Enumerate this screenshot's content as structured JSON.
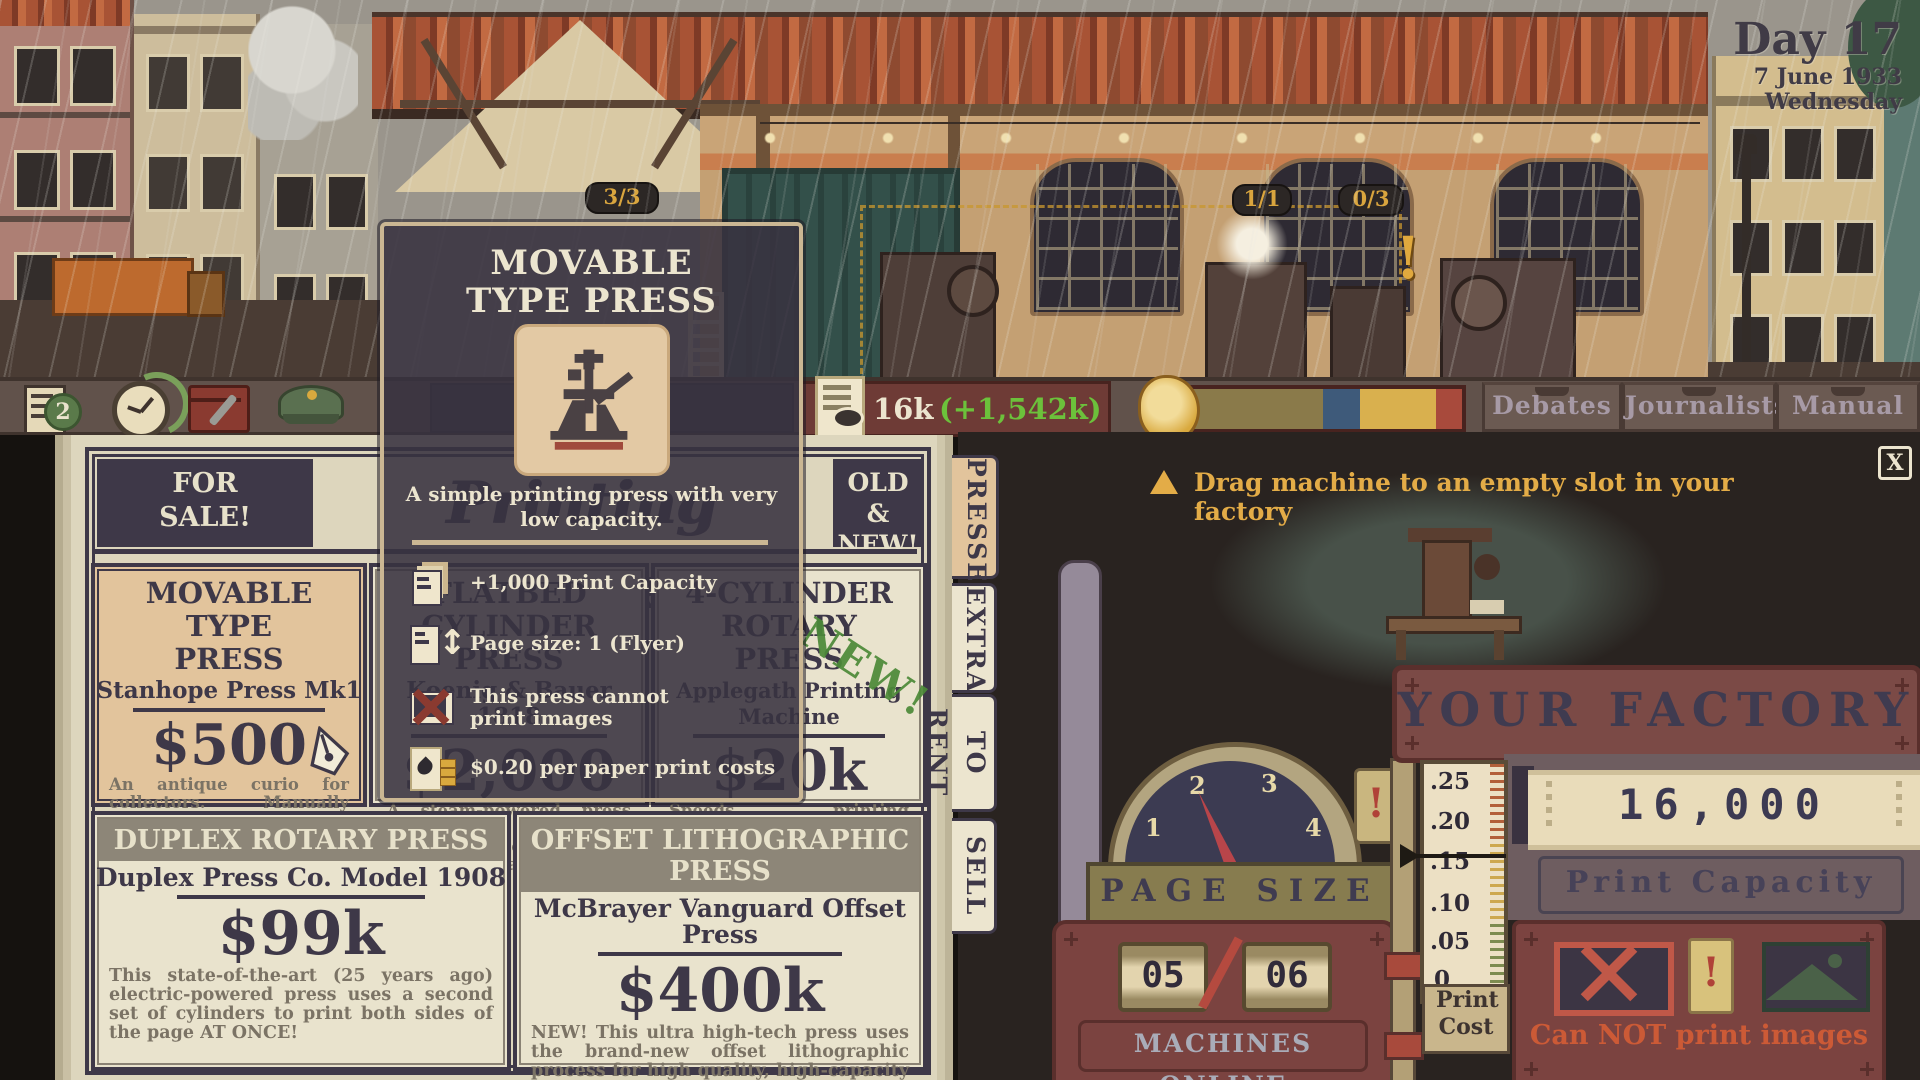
{
  "colors": {
    "money_green": "#6cc13b",
    "warning_gold": "#e3ac47",
    "alert_red": "#cc5a36",
    "paper_cream": "#e9e3cd",
    "ink_dark": "#3e3848",
    "maroon_panel": "#7b4340",
    "selected_tan": "#e2c49c"
  },
  "scene": {
    "date_day": "Day 17",
    "date_line": "7 June 1933",
    "date_weekday": "Wednesday",
    "slot_counters": [
      "3/3",
      "1/1",
      "0/3"
    ],
    "machine_alert": "!"
  },
  "hud": {
    "tasks_count": "2",
    "dim_resource": "20k",
    "money": "16k",
    "money_delta": "(+1,542k)",
    "icons": [
      "tasks-checklist-icon",
      "timer-clock-icon",
      "toolbox-icon",
      "police-cap-icon",
      "hammer-icon",
      "newspaper-stack-icon",
      "gold-paper-icon"
    ],
    "menu": [
      {
        "label": "Debates"
      },
      {
        "label": "Journalists"
      },
      {
        "label": "Manual"
      }
    ]
  },
  "catalog": {
    "sale_tag": "FOR SALE!",
    "title": "Printing Presses",
    "new_tag": "OLD & NEW!",
    "items": [
      {
        "name": "MOVABLE TYPE PRESS",
        "maker": "Stanhope Press Mk1",
        "price": "$500",
        "desc": "An antique curio for collectors. Manually operated. Probably functional.",
        "selected": true
      },
      {
        "name": "FLATBED CYLINDER PRESS",
        "maker": "Koenig & Bauer 1818",
        "price": "$2,000",
        "desc": "A steam-powered press that uses a cylinder to roll paper over a flat stereotype plate."
      },
      {
        "name": "4-CYLINDER ROTARY PRESS",
        "maker": "Applegath Printing Machine",
        "price": "$20k",
        "stamp": "NEW!",
        "desc": "Speeds printing massively by curving the stereotype plate around rotating cylinders."
      },
      {
        "name": "DUPLEX ROTARY PRESS",
        "maker": "Duplex Press Co. Model 1908",
        "price": "$99k",
        "desc": "This state-of-the-art (25 years ago) electric-powered press uses a second set of cylinders to print both sides of the page AT ONCE!"
      },
      {
        "name": "OFFSET LITHOGRAPHIC PRESS",
        "maker": "McBrayer Vanguard Offset Press",
        "price": "$400k",
        "desc": "NEW! This ultra high-tech press uses the brand-new offset lithographic process for high quality, high-capacity printing."
      }
    ]
  },
  "tooltip": {
    "title": "MOVABLE TYPE PRESS",
    "description": "A simple printing press with very low capacity.",
    "stats": [
      {
        "icon": "print-capacity-icon",
        "text": "+1,000 Print Capacity"
      },
      {
        "icon": "page-size-icon",
        "text": "Page size: 1 (Flyer)"
      },
      {
        "icon": "no-images-icon",
        "text": "This press cannot print images"
      },
      {
        "icon": "ink-cost-icon",
        "text": "$0.20 per paper print costs"
      }
    ]
  },
  "tabs": [
    {
      "label": "PRESSES",
      "active": true
    },
    {
      "label": "EXTRAS"
    },
    {
      "label": "TO RENT"
    },
    {
      "label": "SELL"
    }
  ],
  "factory": {
    "hint": "Drag machine to an empty slot in your factory",
    "close_glyph": "X",
    "title": "YOUR FACTORY",
    "page_size_label": "PAGE SIZE",
    "gauge_ticks": [
      "1",
      "2",
      "3",
      "4"
    ],
    "gauge_value": "2",
    "machines_online_label": "MACHINES ONLINE",
    "machines_current": "05",
    "machines_total": "06",
    "cost_scale": [
      ".25",
      ".20",
      ".15",
      ".10",
      ".05",
      "0"
    ],
    "cost_pointer": ".15",
    "print_cost_label": "Print Cost",
    "capacity_value": "16,000",
    "capacity_label": "Print Capacity",
    "images_status": "Can NOT print images",
    "alert_glyph": "!"
  }
}
